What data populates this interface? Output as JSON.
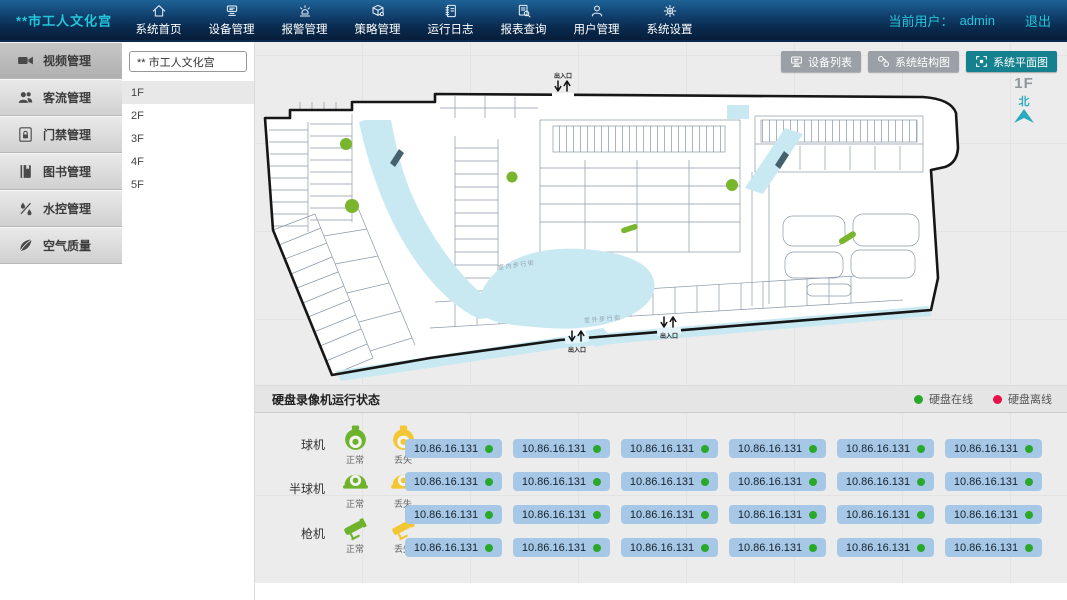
{
  "nav": {
    "title": "**市工人文化宫",
    "items": [
      {
        "label": "系统首页",
        "icon": "home-icon"
      },
      {
        "label": "设备管理",
        "icon": "devices-icon"
      },
      {
        "label": "报警管理",
        "icon": "alarm-icon"
      },
      {
        "label": "策略管理",
        "icon": "strategy-icon"
      },
      {
        "label": "运行日志",
        "icon": "log-icon"
      },
      {
        "label": "报表查询",
        "icon": "report-search-icon"
      },
      {
        "label": "用户管理",
        "icon": "user-icon"
      },
      {
        "label": "系统设置",
        "icon": "settings-icon"
      }
    ],
    "current_user_label": "当前用户：",
    "current_user": "admin",
    "logout_label": "退出"
  },
  "sidebar": {
    "items": [
      {
        "label": "视频管理",
        "icon": "video-camera-icon",
        "active": true
      },
      {
        "label": "客流管理",
        "icon": "people-icon"
      },
      {
        "label": "门禁管理",
        "icon": "door-lock-icon"
      },
      {
        "label": "图书管理",
        "icon": "book-icon"
      },
      {
        "label": "水控管理",
        "icon": "water-icon"
      },
      {
        "label": "空气质量",
        "icon": "leaf-icon"
      }
    ]
  },
  "floor_panel": {
    "building_name": "** 市工人文化宫",
    "floors": [
      {
        "label": "1F",
        "active": true
      },
      {
        "label": "2F"
      },
      {
        "label": "3F"
      },
      {
        "label": "4F"
      },
      {
        "label": "5F"
      }
    ]
  },
  "map_toolbar": {
    "buttons": [
      {
        "label": "设备列表",
        "icon": "device-list-icon"
      },
      {
        "label": "系统结构图",
        "icon": "structure-diagram-icon"
      },
      {
        "label": "系统平面图",
        "icon": "floor-plan-icon",
        "active": true
      }
    ]
  },
  "map": {
    "floor_label": "1F",
    "compass_label": "北",
    "entrance_label": "出入口",
    "indoor_street_label": "室内步行街",
    "outdoor_street_label": "室外步行街"
  },
  "status_panel": {
    "title": "硬盘录像机运行状态",
    "legend": [
      {
        "label": "硬盘在线",
        "color": "#2aa82a"
      },
      {
        "label": "硬盘离线",
        "color": "#e81048"
      }
    ],
    "camera_types": [
      {
        "name": "球机",
        "normal_label": "正常",
        "lost_label": "丢失"
      },
      {
        "name": "半球机",
        "normal_label": "正常",
        "lost_label": "丢失"
      },
      {
        "name": "枪机",
        "normal_label": "正常",
        "lost_label": "丢失"
      }
    ],
    "devices": [
      {
        "ip": "10.86.16.131",
        "status": "online"
      },
      {
        "ip": "10.86.16.131",
        "status": "online"
      },
      {
        "ip": "10.86.16.131",
        "status": "online"
      },
      {
        "ip": "10.86.16.131",
        "status": "online"
      },
      {
        "ip": "10.86.16.131",
        "status": "online"
      },
      {
        "ip": "10.86.16.131",
        "status": "online"
      },
      {
        "ip": "10.86.16.131",
        "status": "online"
      },
      {
        "ip": "10.86.16.131",
        "status": "online"
      },
      {
        "ip": "10.86.16.131",
        "status": "online"
      },
      {
        "ip": "10.86.16.131",
        "status": "online"
      },
      {
        "ip": "10.86.16.131",
        "status": "online"
      },
      {
        "ip": "10.86.16.131",
        "status": "online"
      },
      {
        "ip": "10.86.16.131",
        "status": "online"
      },
      {
        "ip": "10.86.16.131",
        "status": "online"
      },
      {
        "ip": "10.86.16.131",
        "status": "online"
      },
      {
        "ip": "10.86.16.131",
        "status": "online"
      },
      {
        "ip": "10.86.16.131",
        "status": "online"
      },
      {
        "ip": "10.86.16.131",
        "status": "online"
      },
      {
        "ip": "10.86.16.131",
        "status": "online"
      },
      {
        "ip": "10.86.16.131",
        "status": "online"
      },
      {
        "ip": "10.86.16.131",
        "status": "online"
      },
      {
        "ip": "10.86.16.131",
        "status": "online"
      },
      {
        "ip": "10.86.16.131",
        "status": "online"
      },
      {
        "ip": "10.86.16.131",
        "status": "online"
      }
    ]
  },
  "colors": {
    "accent_teal": "#15808e",
    "title_teal": "#25c5d8",
    "camera_normal_green": "#6fb32c",
    "camera_lost_yellow": "#f2c733",
    "chip_background": "#a6c8e6",
    "online_green": "#2aa82a",
    "offline_red": "#e81048"
  }
}
